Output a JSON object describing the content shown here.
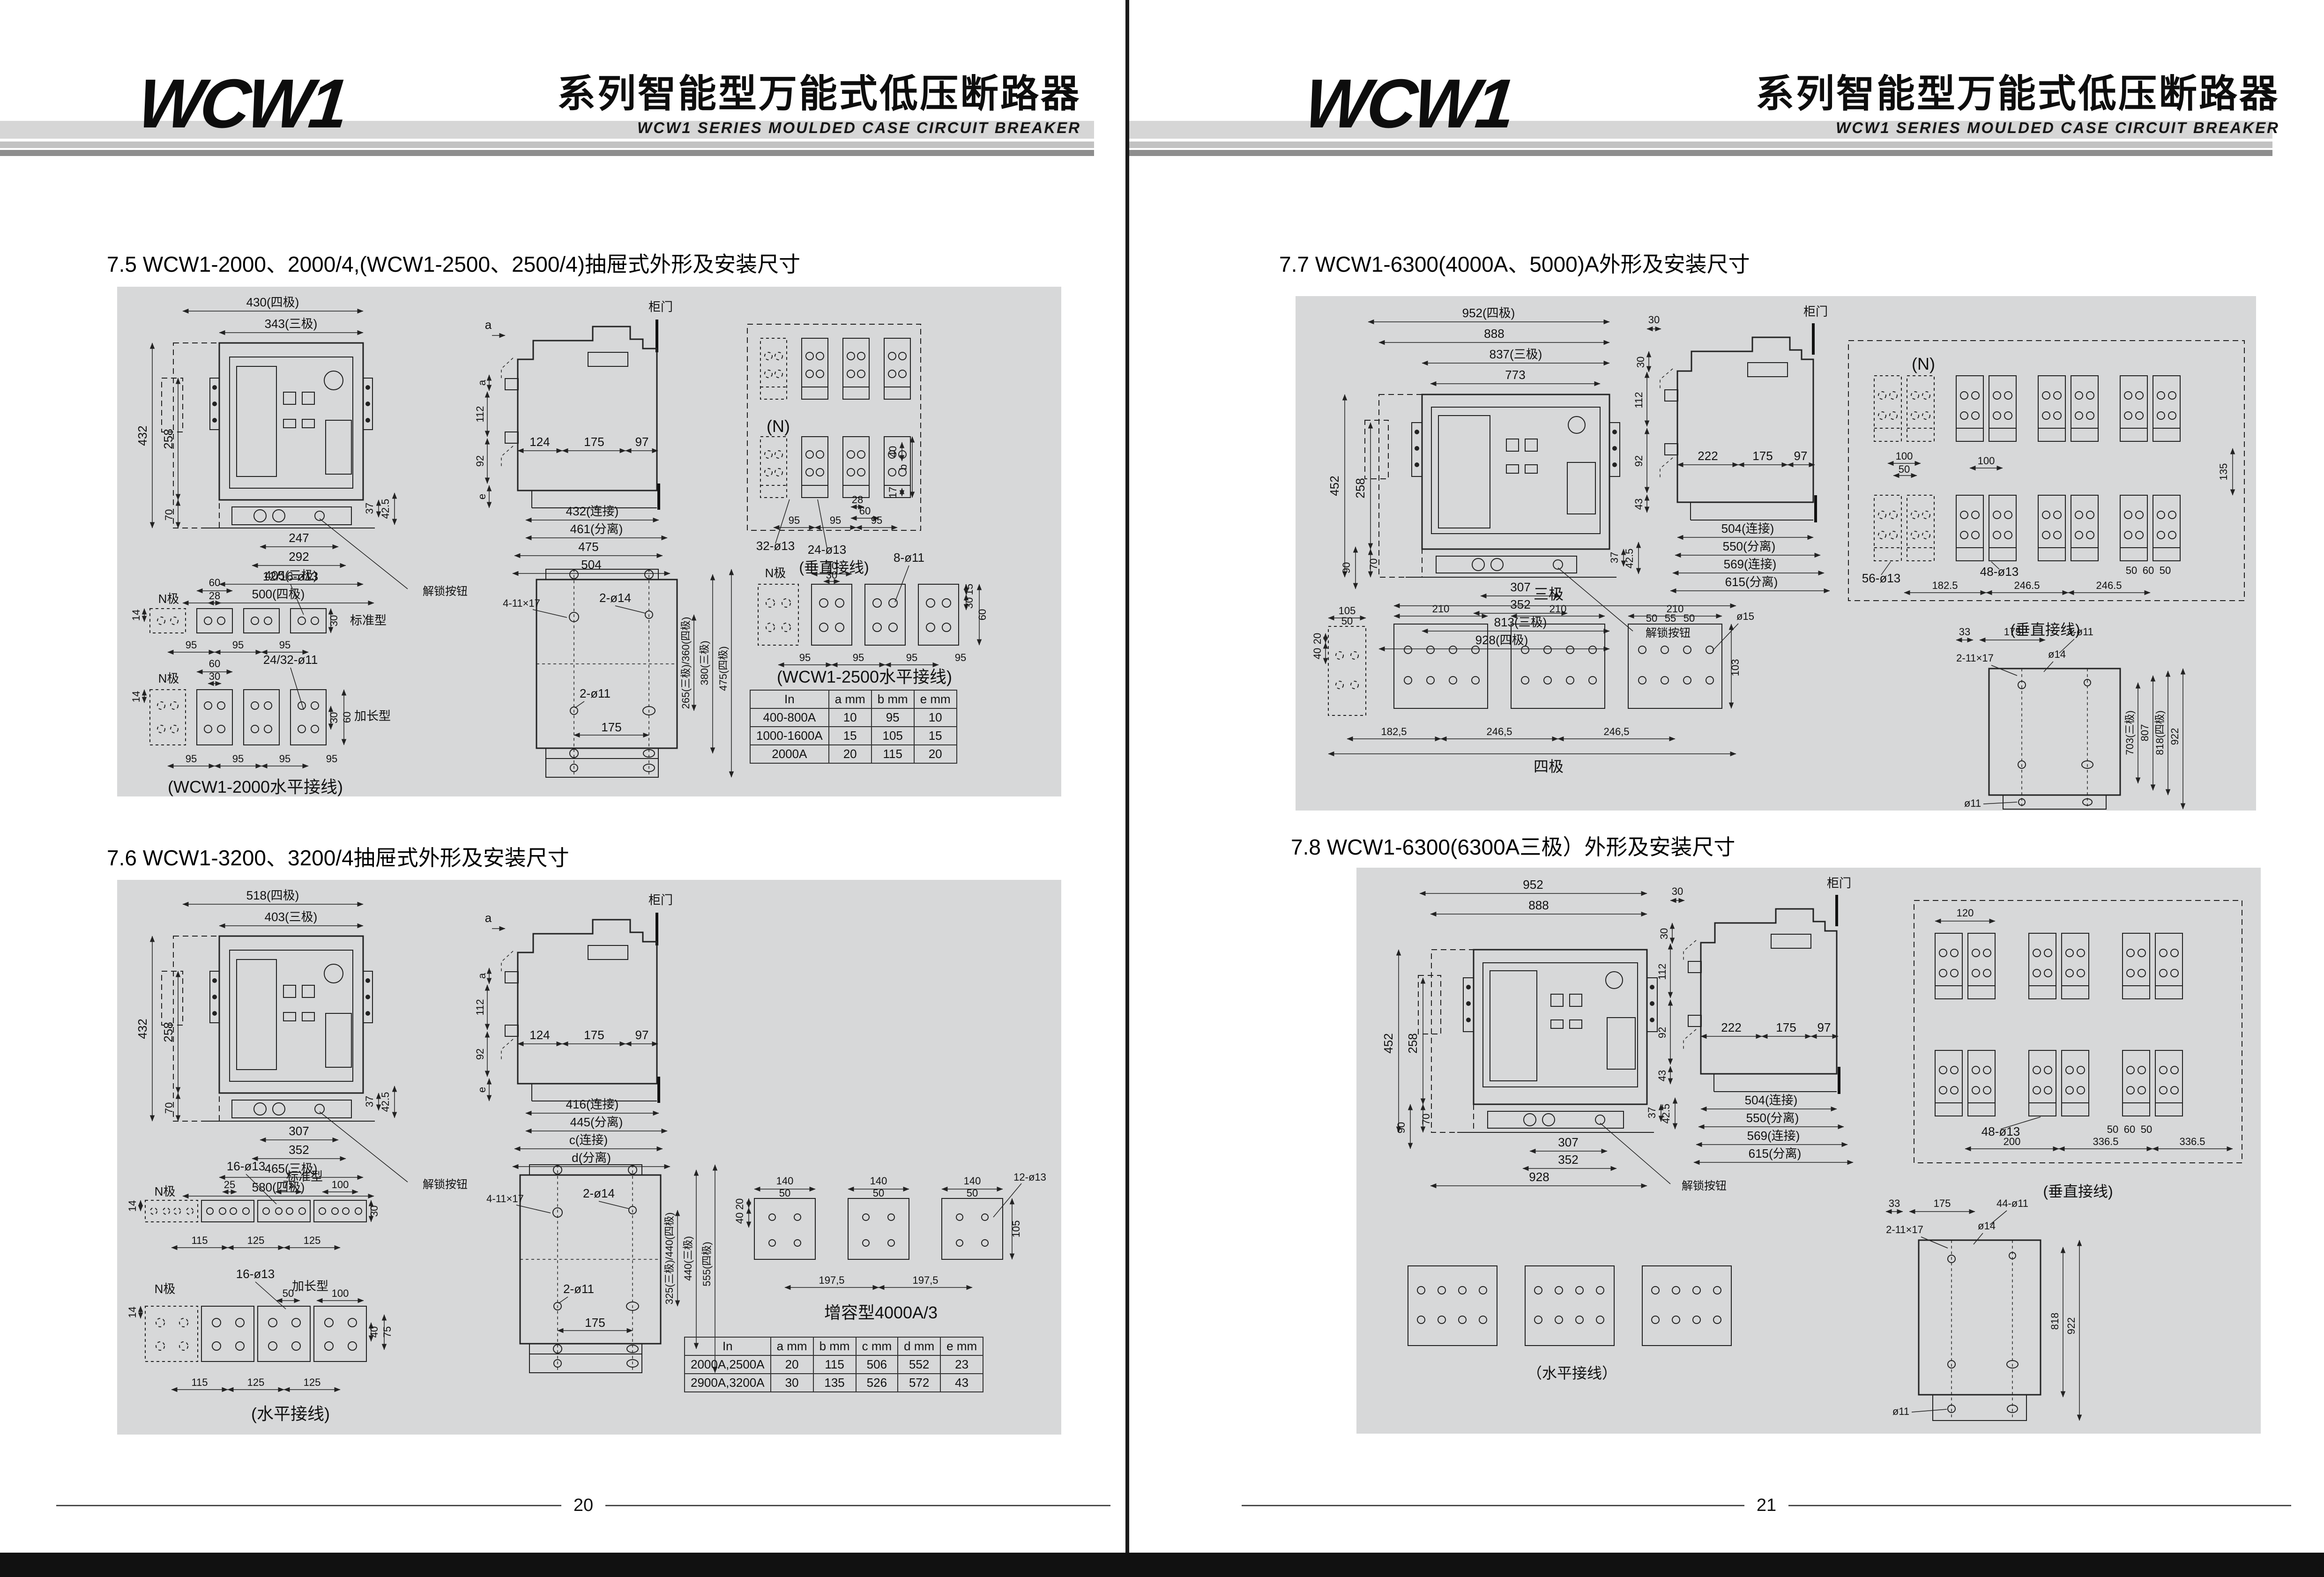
{
  "pl": {
    "logo": "WCW1",
    "title": "系列智能型万能式低压断路器",
    "subtitle": "WCW1 SERIES MOULDED CASE CIRCUIT BREAKER",
    "page_no": "20",
    "s75": {
      "title": "7.5  WCW1-2000、2000/4,(WCW1-2500、2500/4)抽屉式外形及安装尺寸",
      "front": {
        "w4": "430(四极)",
        "w3": "343(三极)",
        "h432": "432",
        "h258": "258",
        "h70": "70",
        "d37": "37",
        "d425": "42.5",
        "b247": "247",
        "b292": "292",
        "b405": "405(三极)",
        "b500": "500(四极)",
        "unlock": "解锁按钮"
      },
      "side": {
        "door": "柜门",
        "a": "a",
        "v112": "112",
        "v92": "92",
        "e": "e",
        "d124": "124",
        "d175": "175",
        "d97": "97",
        "b432": "432(连接)",
        "b461": "461(分离)",
        "b475": "475",
        "b504": "504"
      },
      "vt": {
        "n": "(N)",
        "hole32": "32-ø13",
        "hole24": "24-ø13",
        "d28": "28",
        "d60": "60",
        "p95": "95",
        "d40": "40",
        "d17": "17",
        "b": "b",
        "cap": "(垂直接线)"
      },
      "h2000": {
        "n": "N极",
        "std": "标准型",
        "ext": "加长型",
        "d60": "60",
        "d28": "28",
        "hole12": "12/16-ø13",
        "d14": "14",
        "d30": "30",
        "p95": "95",
        "d30b": "30",
        "hole24": "24/32-ø11",
        "d60b": "60",
        "cap": "(WCW1-2000水平接线)"
      },
      "mp": {
        "hole4": "4-11×17",
        "hole214": "2-ø14",
        "hole211": "2-ø11",
        "d175": "175",
        "v1": "265(三极)/360(四极)",
        "v2": "380(三极)",
        "v3": "475(四极)"
      },
      "h2500": {
        "n": "N极",
        "d70": "70",
        "d30": "30",
        "hole8": "8-ø11",
        "d15": "15",
        "d30b": "30",
        "d60": "60",
        "p95": "95",
        "cap": "(WCW1-2500水平接线)"
      },
      "table": {
        "headers": [
          "In",
          "a  mm",
          "b  mm",
          "e  mm"
        ],
        "rows": [
          [
            "400-800A",
            "10",
            "95",
            "10"
          ],
          [
            "1000-1600A",
            "15",
            "105",
            "15"
          ],
          [
            "2000A",
            "20",
            "115",
            "20"
          ]
        ]
      }
    },
    "s76": {
      "title": "7.6  WCW1-3200、3200/4抽屉式外形及安装尺寸",
      "front": {
        "w4": "518(四极)",
        "w3": "403(三极)",
        "h432": "432",
        "h258": "258",
        "h70": "70",
        "d37": "37",
        "d425": "42.5",
        "b307": "307",
        "b352": "352",
        "b465": "465(三极)",
        "b580": "580(四极)",
        "unlock": "解锁按钮"
      },
      "side": {
        "door": "柜门",
        "a": "a",
        "v112": "112",
        "v92": "92",
        "e": "e",
        "d124": "124",
        "d175": "175",
        "d97": "97",
        "b416": "416(连接)",
        "b445": "445(分离)",
        "bc": "c(连接)",
        "bd": "d(分离)"
      },
      "hstd": {
        "hole16": "16-ø13",
        "n": "N极",
        "std": "标准型",
        "d25": "25",
        "d75": "75",
        "d100": "100",
        "d14": "14",
        "d30": "30",
        "p115": "115",
        "p125": "125"
      },
      "hext": {
        "hole16": "16-ø13",
        "n": "N极",
        "ext": "加长型",
        "d50": "50",
        "d100": "100",
        "d14": "14",
        "d40": "40",
        "d75": "75",
        "p115": "115",
        "p125": "125",
        "cap": "(水平接线)"
      },
      "mp": {
        "hole4": "4-11×17",
        "hole214": "2-ø14",
        "hole211": "2-ø11",
        "d175": "175",
        "v1": "325(三极)/440(四极)",
        "v2": "440(三极)",
        "v3": "555(四极)"
      },
      "boost": {
        "d140": "140",
        "d50": "50",
        "d20": "20",
        "d40": "40",
        "d105": "105",
        "hole12": "12-ø13",
        "p1975": "197,5",
        "cap": "增容型4000A/3"
      },
      "table": {
        "headers": [
          "In",
          "a mm",
          "b mm",
          "c mm",
          "d mm",
          "e mm"
        ],
        "rows": [
          [
            "2000A,2500A",
            "20",
            "115",
            "506",
            "552",
            "23"
          ],
          [
            "2900A,3200A",
            "30",
            "135",
            "526",
            "572",
            "43"
          ]
        ]
      }
    }
  },
  "pr": {
    "logo": "WCW1",
    "title": "系列智能型万能式低压断路器",
    "subtitle": "WCW1 SERIES MOULDED CASE CIRCUIT BREAKER",
    "page_no": "21",
    "s77": {
      "title": "7.7  WCW1-6300(4000A、5000)A外形及安装尺寸",
      "front": {
        "w952": "952(四极)",
        "w888": "888",
        "w837": "837(三极)",
        "w773": "773",
        "h452": "452",
        "h258": "258",
        "h90": "90",
        "h70": "70",
        "d37": "37",
        "d425": "42.5",
        "b307": "307",
        "b352": "352",
        "b813": "813(三极)",
        "b928": "928(四极)",
        "unlock": "解锁按钮"
      },
      "side": {
        "door": "柜门",
        "d30": "30",
        "d30b": "30",
        "v112": "112",
        "v92": "92",
        "v43": "43",
        "d222": "222",
        "d175": "175",
        "d97": "97",
        "b504": "504(连接)",
        "b550": "550(分离)",
        "b569": "569(连接)",
        "b615": "615(分离)"
      },
      "vt": {
        "n": "(N)",
        "d100": "100",
        "d50": "50",
        "d100b": "100",
        "hole56": "56-ø13",
        "hole48": "48-ø13",
        "d50a": "50",
        "d60": "60",
        "d50b": "50",
        "d1825": "182.5",
        "d2465": "246.5",
        "d135": "135",
        "cap": "(垂直接线)"
      },
      "hz": {
        "t3": "三极",
        "t4": "四极",
        "d105": "105",
        "d50": "50",
        "d210": "210",
        "d50a": "50",
        "d55": "55",
        "d50b": "50",
        "hole15": "ø15",
        "d103": "103",
        "d20": "20",
        "d40": "40",
        "d1825": "182,5",
        "d2465": "246,5"
      },
      "mp": {
        "d33": "33",
        "d175": "175",
        "hole4": "4-ø11",
        "hole2": "2-11×17",
        "hole14": "ø14",
        "hole11": "ø11",
        "v703": "703(三极)",
        "v807": "807",
        "v818": "818(四极)",
        "v922": "922"
      }
    },
    "s78": {
      "title": "7.8  WCW1-6300(6300A三极）外形及安装尺寸",
      "front": {
        "w952": "952",
        "w888": "888",
        "h452": "452",
        "h258": "258",
        "h90": "90",
        "h70": "70",
        "d37": "37",
        "d425": "42.5",
        "b307": "307",
        "b352": "352",
        "b928": "928",
        "unlock": "解锁按钮"
      },
      "side": {
        "door": "柜门",
        "d30": "30",
        "d30b": "30",
        "v112": "112",
        "v92": "92",
        "v43": "43",
        "d222": "222",
        "d175": "175",
        "d97": "97",
        "b504": "504(连接)",
        "b550": "550(分离)",
        "b569": "569(连接)",
        "b615": "615(分离)"
      },
      "vt": {
        "d120": "120",
        "hole48": "48-ø13",
        "d50a": "50",
        "d60": "60",
        "d50b": "50",
        "d200": "200",
        "d3365": "336.5",
        "cap": "(垂直接线)"
      },
      "hz": {
        "cap": "（水平接线）"
      },
      "mp": {
        "d33": "33",
        "d175": "175",
        "hole44": "44-ø11",
        "hole2": "2-11×17",
        "hole14": "ø14",
        "hole11": "ø11",
        "v818": "818",
        "v922": "922"
      }
    }
  }
}
